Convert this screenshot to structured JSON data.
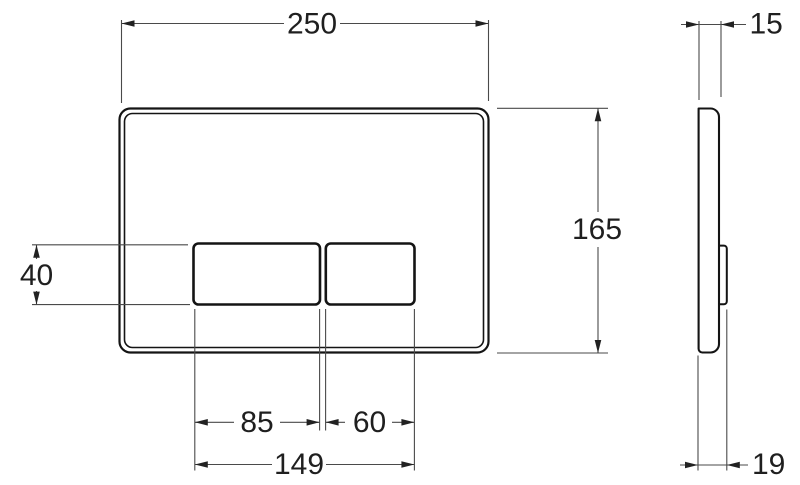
{
  "dims": {
    "plate_width": "250",
    "plate_height": "165",
    "plate_thickness": "15",
    "button_height": "40",
    "large_button_width": "85",
    "small_button_width": "60",
    "buttons_overall_width": "149",
    "overall_depth": "19"
  },
  "colors": {
    "background": "#ffffff",
    "part_outline": "#141414",
    "dimension_line": "#4a4a4a",
    "label_text": "#1f1f1f"
  }
}
